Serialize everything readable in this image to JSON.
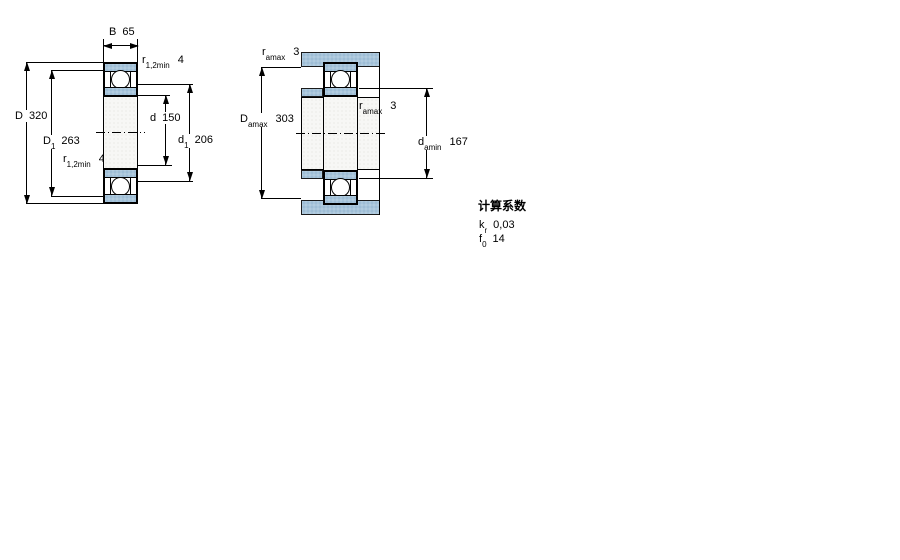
{
  "left_figure": {
    "B": {
      "sym": "B",
      "val": "65"
    },
    "r_top": {
      "sym": "r",
      "sub": "1,2min",
      "val": "4"
    },
    "D": {
      "sym": "D",
      "val": "320"
    },
    "D1": {
      "sym": "D",
      "sub": "1",
      "val": "263"
    },
    "d": {
      "sym": "d",
      "val": "150"
    },
    "d1": {
      "sym": "d",
      "sub": "1",
      "val": "206"
    },
    "r_bot": {
      "sym": "r",
      "sub": "1,2min",
      "val": "4"
    }
  },
  "right_figure": {
    "r_a_top": {
      "sym": "r",
      "sub": "amax",
      "val": "3"
    },
    "Da": {
      "sym": "D",
      "sub": "amax",
      "val": "303"
    },
    "r_a_mid": {
      "sym": "r",
      "sub": "amax",
      "val": "3"
    },
    "da": {
      "sym": "d",
      "sub": "amin",
      "val": "167"
    }
  },
  "calculation_factors": {
    "title": "计算系数",
    "rows": [
      {
        "sym": "k",
        "sub": "r",
        "val": "0,03"
      },
      {
        "sym": "f",
        "sub": "0",
        "val": "14"
      }
    ]
  },
  "colors": {
    "section_blue": "#a8c5db",
    "section_dot": "#7fa6c2",
    "line": "#000000",
    "background": "#ffffff"
  }
}
